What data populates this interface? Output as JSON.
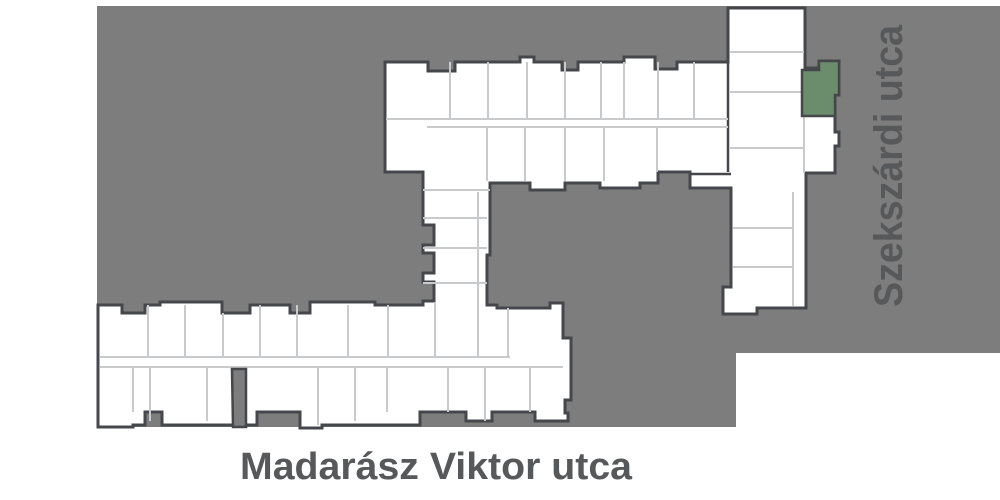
{
  "streets": {
    "right_vertical": "Szekszárdi utca",
    "bottom_horizontal": "Madarász Viktor utca"
  },
  "highlighted_unit": {
    "state": "selected"
  },
  "colors": {
    "background": "#ffffff",
    "street_area": "#7d7d7d",
    "building_fill": "#ffffff",
    "building_wall": "#45474a",
    "unit_divider": "#c9cacb",
    "highlight_green": "#6b8d6c",
    "street_label": "#575859"
  }
}
